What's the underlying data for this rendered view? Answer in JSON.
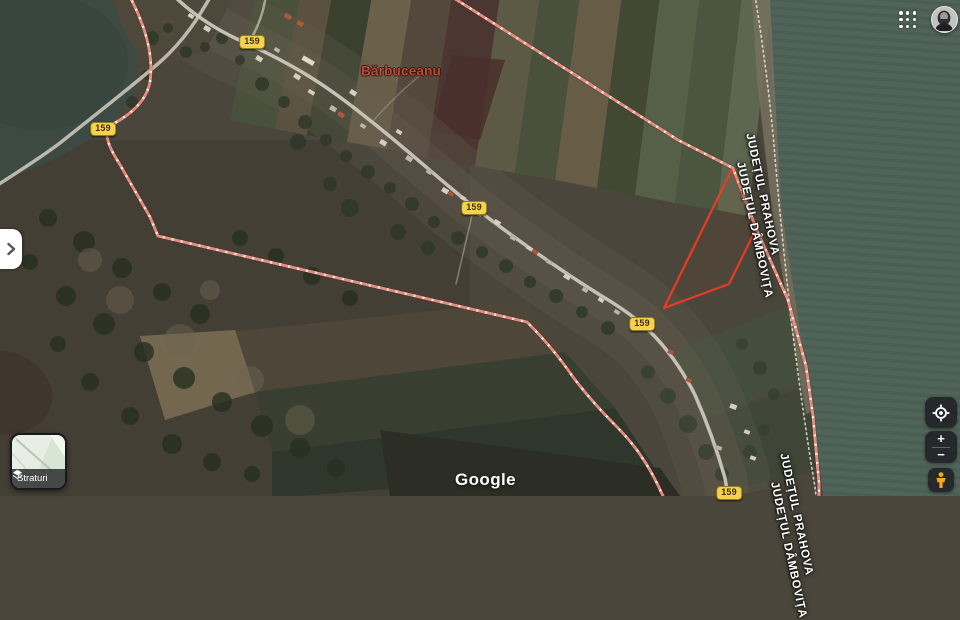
{
  "map": {
    "place_label": "Bărbuceanu",
    "route_number": "159",
    "boundary": {
      "county_right": "JUDEȚUL PRAHOVA",
      "county_left": "JUDEȚUL DÂMBOVIȚA"
    }
  },
  "attribution": {
    "logo": "Google"
  },
  "controls": {
    "layers": {
      "label": "Straturi"
    },
    "zoom_in": "+",
    "zoom_out": "−"
  },
  "icons": {
    "apps_grid": "3x3-dots",
    "account_avatar": "portrait-photo",
    "panel_expand": "chevron-right",
    "layers": "stacked-diamonds",
    "my_location": "crosshair-target",
    "street_view": "pegman"
  },
  "colors": {
    "route_badge": "#f6d14b",
    "place_label": "#bf4937",
    "boundary_dash": "#e78b7e",
    "parcel_outline": "#f03c21",
    "field_green": "#51645a",
    "control_bg": "#202124"
  }
}
